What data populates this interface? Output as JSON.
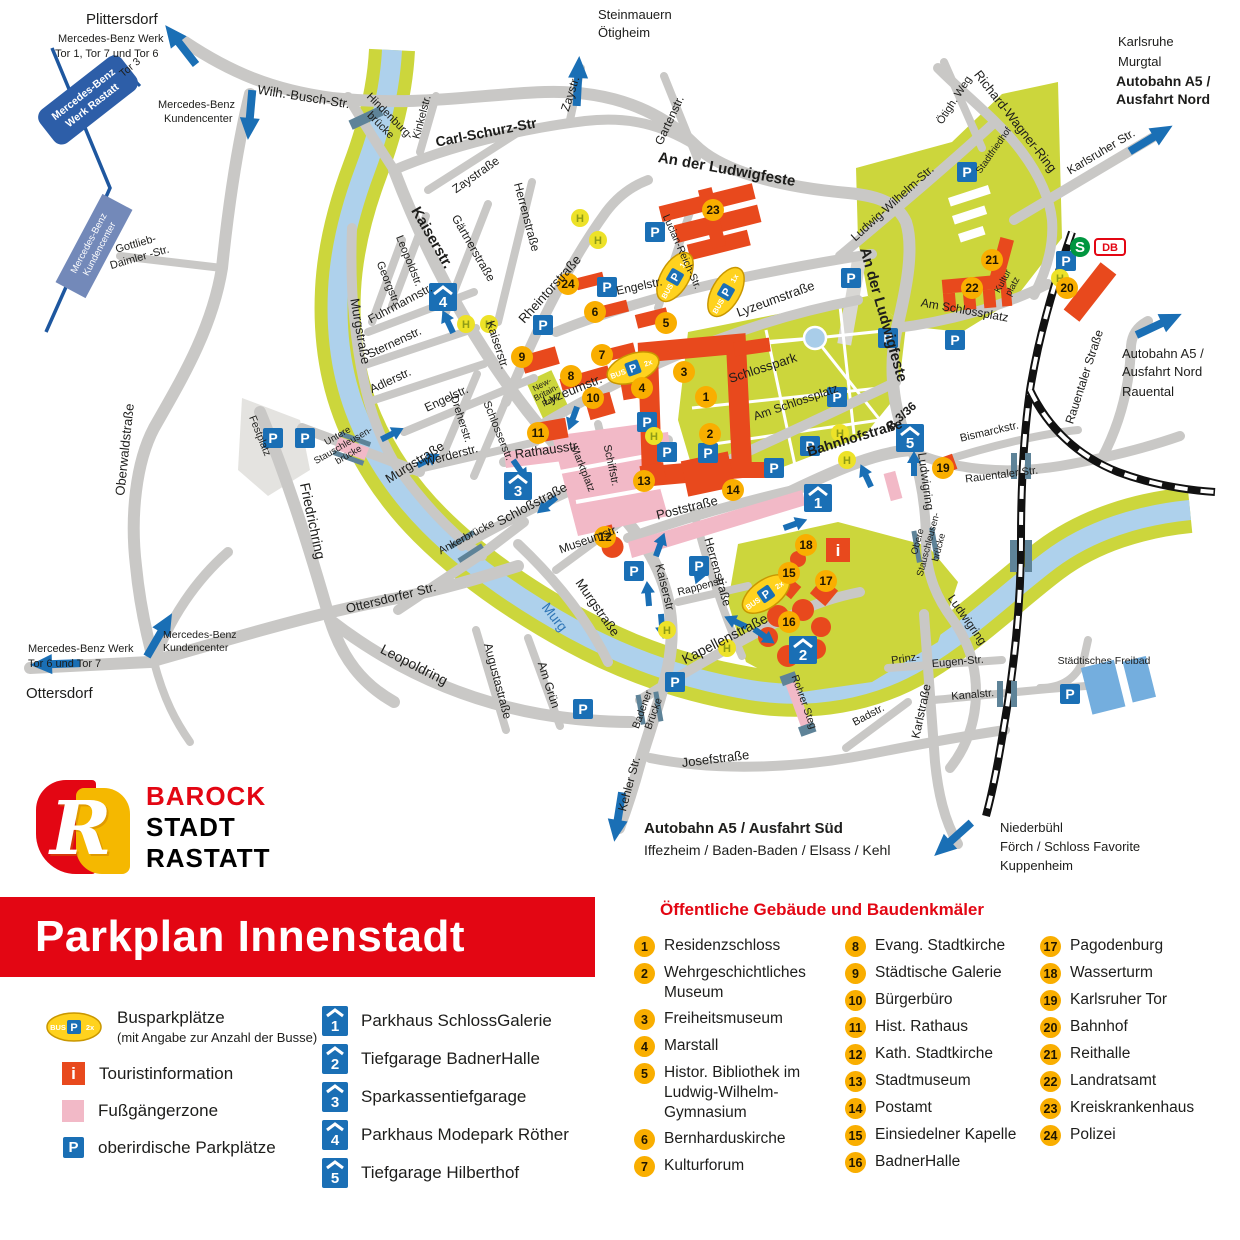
{
  "banner": {
    "title": "Parkplan Innenstadt"
  },
  "logo": {
    "monogram": "R",
    "l1": "BAROCK",
    "l2": "STADT",
    "l3": "RASTATT"
  },
  "icons": {
    "parking": "P",
    "bus_stop": "H",
    "info": "i",
    "bus": "BUS",
    "sbahn": "S",
    "db": "DB"
  },
  "bus": {
    "x1": "1x",
    "x2": "2x"
  },
  "legend": {
    "bus_title": "Busparkplätze",
    "bus_sub": "(mit Angabe zur Anzahl der Busse)",
    "info": "Touristinformation",
    "pedestrian": "Fußgängerzone",
    "parking": "oberirdische Parkplätze"
  },
  "parkhaus": {
    "items": [
      {
        "num": "1",
        "label": "Parkhaus SchlossGalerie"
      },
      {
        "num": "2",
        "label": "Tiefgarage BadnerHalle"
      },
      {
        "num": "3",
        "label": "Sparkassentiefgarage"
      },
      {
        "num": "4",
        "label": "Parkhaus Modepark Röther"
      },
      {
        "num": "5",
        "label": "Tiefgarage Hilberthof"
      }
    ]
  },
  "buildings": {
    "title": "Öffentliche Gebäude und Baudenkmäler",
    "items": [
      {
        "num": "1",
        "label": "Residenzschloss"
      },
      {
        "num": "2",
        "label": "Wehrgeschichtliches Museum"
      },
      {
        "num": "3",
        "label": "Freiheitsmuseum"
      },
      {
        "num": "4",
        "label": "Marstall"
      },
      {
        "num": "5",
        "label": "Histor. Bibliothek im Ludwig-Wilhelm-Gymnasium"
      },
      {
        "num": "6",
        "label": "Bernharduskirche"
      },
      {
        "num": "7",
        "label": "Kulturforum"
      },
      {
        "num": "8",
        "label": "Evang. Stadtkirche"
      },
      {
        "num": "9",
        "label": "Städtische Galerie"
      },
      {
        "num": "10",
        "label": "Bürgerbüro"
      },
      {
        "num": "11",
        "label": "Hist. Rathaus"
      },
      {
        "num": "12",
        "label": "Kath. Stadtkirche"
      },
      {
        "num": "13",
        "label": "Stadtmuseum"
      },
      {
        "num": "14",
        "label": "Postamt"
      },
      {
        "num": "15",
        "label": "Einsiedelner Kapelle"
      },
      {
        "num": "16",
        "label": "BadnerHalle"
      },
      {
        "num": "17",
        "label": "Pagodenburg"
      },
      {
        "num": "18",
        "label": "Wasserturm"
      },
      {
        "num": "19",
        "label": "Karlsruher Tor"
      },
      {
        "num": "20",
        "label": "Bahnhof"
      },
      {
        "num": "21",
        "label": "Reithalle"
      },
      {
        "num": "22",
        "label": "Landratsamt"
      },
      {
        "num": "23",
        "label": "Kreiskrankenhaus"
      },
      {
        "num": "24",
        "label": "Polizei"
      }
    ]
  },
  "destinations": {
    "plittersdorf": "Plittersdorf",
    "mb_werk1a": "Mercedes-Benz Werk",
    "mb_werk1b": "Tor 1, Tor 7 und Tor 6",
    "mb_box1a": "Mercedes-Benz",
    "mb_box1b": "Werk Rastatt",
    "mb_box2a": "Mercedes-Benz",
    "mb_box2b": "Kundencenter",
    "kundencenter1": "Mercedes-Benz",
    "kundencenter2": "Kundencenter",
    "steinmauern": "Steinmauern",
    "oetigheim": "Ötigheim",
    "karlsruhe": "Karlsruhe",
    "murgtal": "Murgtal",
    "autobahn_nord1": "Autobahn A5 /",
    "autobahn_nord2": "Ausfahrt Nord",
    "rauental": "Rauental",
    "mb_werk6a": "Mercedes-Benz Werk",
    "mb_werk6b": "Tor 6 und Tor 7",
    "ottersdorf": "Ottersdorf",
    "autobahn_sued1": "Autobahn A5 / Ausfahrt Süd",
    "autobahn_sued2": "Iffezheim / Baden-Baden / Elsass / Kehl",
    "niederbuehl1": "Niederbühl",
    "niederbuehl2": "Förch / Schloss Favorite",
    "niederbuehl3": "Kuppenheim"
  },
  "streets": {
    "wilh_busch": "Wilh.-Busch-Str.",
    "hindenburg1": "Hindenburg-",
    "hindenburg2": "brücke",
    "kinkelstr": "Kinkelstr.",
    "carl_schurz": "Carl-Schurz-Str",
    "zaystr": "Zaystr.",
    "zaystrasse": "Zaystraße",
    "gartenstr": "Gartenstr.",
    "ludwigfeste": "An der Ludwigfeste",
    "richard_wagner": "Richard-Wagner-Ring",
    "oetigh_weg": "Ötigh. Weg",
    "karlsruher_str": "Karlsruher Str.",
    "ludwig_wilhelm": "Ludwig-Wilhelm-Str.",
    "lucian_reich": "Lucian-Reich-Str.",
    "herrenstrasse": "Herrenstraße",
    "rheintorstrasse": "Rheintorstraße",
    "kaiserstr": "Kaiserstr.",
    "kaiserstr_plain": "Kaiserstr",
    "gaertnerstrasse": "Gärtnerstraße",
    "leopoldstr": "Leopoldstr.",
    "georgstr": "Georgstr.",
    "fuhrmannstr": "Fuhrmannstr.",
    "sternenstr": "Sternenstr.",
    "adlerstr": "Adlerstr.",
    "murgstrasse": "Murgstraße",
    "engelstr": "Engelstr.",
    "dreherstr": "Dreherstr.",
    "schlosserstr": "Schlosserstr.",
    "lyzeumstr": "Lyzeumstr.",
    "lyzeumstrasse": "Lyzeumstraße",
    "werderstr": "Werderstr.",
    "rathausstr": "Rathausstr.",
    "schiffstr": "Schiffstr.",
    "schlossstrasse": "Schloßstraße",
    "museumstr": "Museumstr.",
    "untere1": "Untere",
    "stauschleusen": "Stauschleusen-",
    "bruecke": "brücke",
    "obere1": "Obere",
    "friedrichring": "Friedrichring",
    "ankerbruecke": "Ankerbrücke",
    "ottersdorfer_str": "Ottersdorfer Str.",
    "leopoldring": "Leopoldring",
    "augustastrasse": "Augustastraße",
    "am_gruen": "Am Grün",
    "poststrasse": "Poststraße",
    "rappenstr": "Rappenstr.",
    "kapellenstrasse": "Kapellenstraße",
    "bahnhofstrasse": "Bahnhofstraße",
    "b336": "B 3/36",
    "am_schlossplatz": "Am Schlossplatz",
    "bismarckstr": "Bismarckstr.",
    "rauentaler_str": "Rauentaler Str.",
    "rauentaler_strasse": "Rauentaler Straße",
    "ludwigring": "Ludwigring",
    "josefstrasse": "Josefstraße",
    "kehler_str": "Kehler Str.",
    "badener1": "Badener",
    "badener2": "Brücke",
    "rohrer_steg": "Rohrer Steg",
    "badstr": "Badstr.",
    "karlstrasse": "Karlstraße",
    "kanalstr": "Kanalstr.",
    "prinz": "Prinz-",
    "eugen_str": "Eugen-Str.",
    "gottlieb1": "Gottlieb-",
    "gottlieb2": "Daimler -Str.",
    "oberwaldstrasse": "Oberwaldstraße",
    "tor3": "Tor 3"
  },
  "places": {
    "schlosspark": "Schlosspark",
    "festplatz": "Festplatz",
    "marktplatz": "Marktplatz",
    "new_britain1": "New-",
    "new_britain2": "Britain-",
    "new_britain3": "Park",
    "kulturplatz1": "Kultur",
    "kulturplatz2": "platz",
    "stadtfriedhof": "Stadtfriedhof",
    "murg": "Murg",
    "freibad": "Städtisches Freibad"
  }
}
